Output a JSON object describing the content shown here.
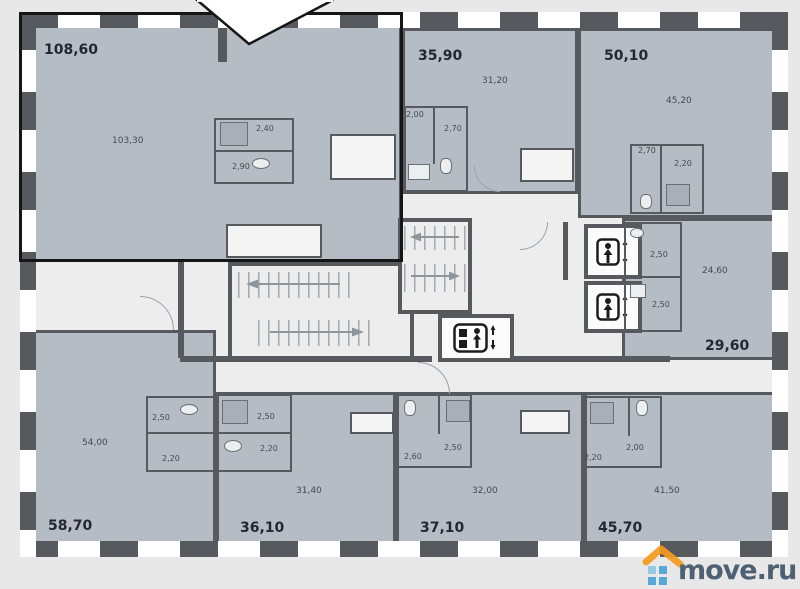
{
  "page": {
    "background": "#e8e8e8"
  },
  "plan": {
    "colors": {
      "wall": "#56595e",
      "apartment_fill": "#b6bcc4",
      "corridor_fill": "#ededee",
      "window": "#ffffff",
      "highlight_border": "#161616",
      "balcony_fill": "#f4f4f4"
    },
    "apartments": [
      {
        "name": "apartment-108-60",
        "total": "108,60",
        "main_room": "103,30",
        "rooms": [
          "2,40",
          "2,90"
        ],
        "highlighted": true
      },
      {
        "name": "apartment-35-90",
        "total": "35,90",
        "main_room": "31,20",
        "rooms": [
          "2,00",
          "2,70"
        ],
        "highlighted": false
      },
      {
        "name": "apartment-50-10",
        "total": "50,10",
        "main_room": "45,20",
        "rooms": [
          "2,70",
          "2,20"
        ],
        "highlighted": false
      },
      {
        "name": "apartment-29-60",
        "total": "29,60",
        "main_room": "24,60",
        "rooms": [
          "2,50",
          "2,50"
        ],
        "highlighted": false
      },
      {
        "name": "apartment-58-70",
        "total": "58,70",
        "main_room": "54,00",
        "rooms": [
          "2,50",
          "2,20"
        ],
        "highlighted": false
      },
      {
        "name": "apartment-36-10",
        "total": "36,10",
        "main_room": "31,40",
        "rooms": [
          "2,50",
          "2,20"
        ],
        "highlighted": false
      },
      {
        "name": "apartment-37-10",
        "total": "37,10",
        "main_room": "32,00",
        "rooms": [
          "2,60",
          "2,50"
        ],
        "highlighted": false
      },
      {
        "name": "apartment-45-70",
        "total": "45,70",
        "main_room": "41,50",
        "rooms": [
          "2,20",
          "2,00"
        ],
        "highlighted": false
      }
    ],
    "core": {
      "passenger_elevators": 2,
      "freight_elevators": 1,
      "staircases": 2
    },
    "icons": {
      "passenger_elevator": "person-with-updown-arrow",
      "freight_elevator": "freight-person-with-updown-arrow",
      "stairs": "hatched-flight-with-arrow"
    }
  },
  "watermark": {
    "text": "move.ru",
    "roof_color": "#f59b1e",
    "squares_color": "#4aa3d8",
    "text_color": "#41566a"
  }
}
